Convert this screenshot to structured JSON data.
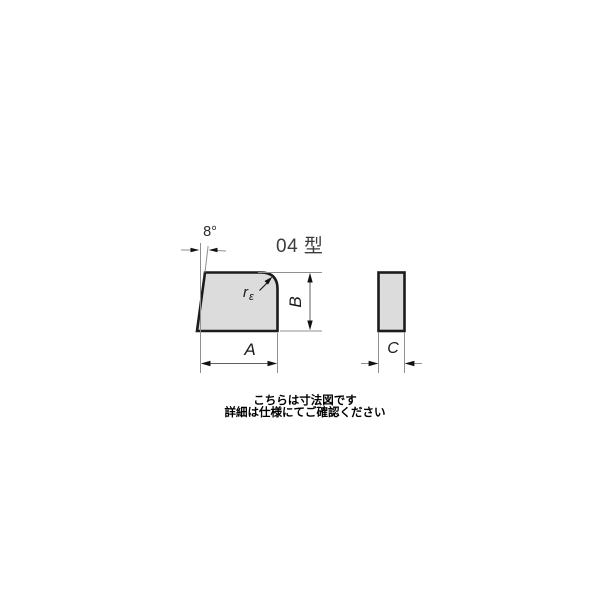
{
  "drawing": {
    "title": "04 型",
    "angle_label": "8°",
    "radius_label": {
      "base": "r",
      "sub": "ε"
    },
    "dims": {
      "a": "A",
      "b": "B",
      "c": "C"
    },
    "colors": {
      "shape_fill": "#dcdcdc",
      "shape_outline": "#1c1c1c",
      "extension_line": "#8f8f8f",
      "dimension_line": "#5f5f5f",
      "arrowhead": "#111111",
      "title_text": "#3c3c3c",
      "caption_text": "#000000"
    }
  },
  "caption": {
    "line1": "こちらは寸法図です",
    "line2": "詳細は仕様にてご確認ください"
  }
}
